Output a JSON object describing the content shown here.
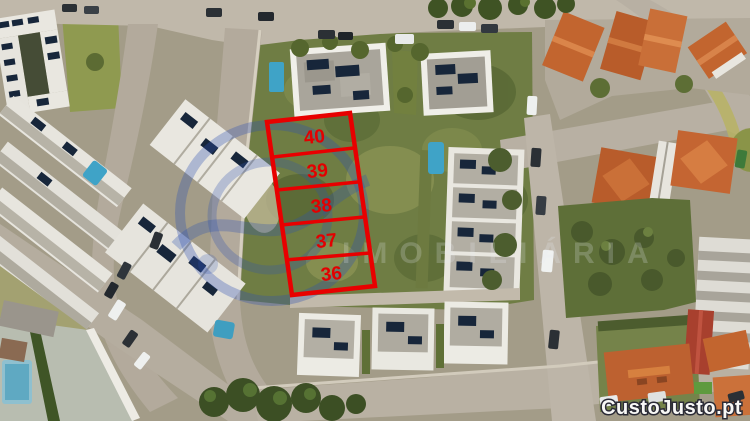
{
  "plots": {
    "labels": [
      "40",
      "39",
      "38",
      "37",
      "36"
    ],
    "outline_color": "#e80000",
    "label_color": "#e30000"
  },
  "watermarks": {
    "portal_brand": "CustoJusto.pt",
    "agency_text": "IMOBILIÁRIA",
    "logo_color": "#2e52b0"
  },
  "palette": {
    "field_green": "#6f7d44",
    "lawn_green": "#8f9a50",
    "tree_green": "#3c4f24",
    "road_grey": "#b3aa9c",
    "roof_white": "#e9e7e0",
    "roof_grey": "#a9a59b",
    "roof_orange": "#c2652f",
    "roof_red": "#a8402e",
    "pool_blue": "#3fa3c7",
    "solar_panel": "#17263a"
  }
}
